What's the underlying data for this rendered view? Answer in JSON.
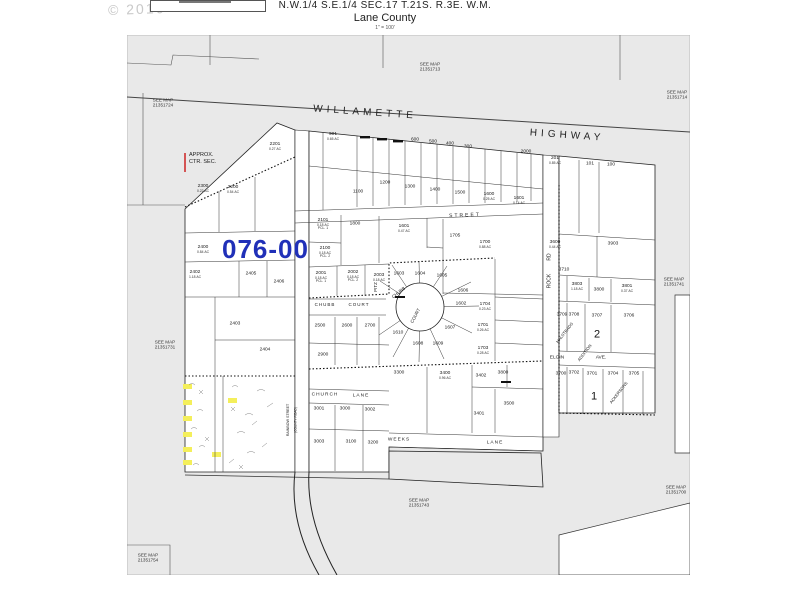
{
  "header": {
    "line1": "N.W.1/4 S.E.1/4 SEC.17 T.21S. R.3E. W.M.",
    "line2": "Lane County",
    "scale": "1\" = 100'",
    "copyright": "© 2016"
  },
  "map": {
    "district_code": "076-00",
    "approx_note_line1": "APPROX.",
    "approx_note_line2": "CTR. SEC.",
    "see_map_prefix": "SEE MAP",
    "colors": {
      "district": "#2030b8",
      "highlight": "#f4ef5b",
      "map_bg": "#e9e9e9",
      "tick": "#cc2222"
    },
    "see_maps": [
      {
        "ref": "21351713",
        "x": 303,
        "y": 32
      },
      {
        "ref": "21351724",
        "x": 36,
        "y": 68
      },
      {
        "ref": "21351714",
        "x": 550,
        "y": 60
      },
      {
        "ref": "21351741",
        "x": 547,
        "y": 247
      },
      {
        "ref": "21351731",
        "x": 38,
        "y": 310
      },
      {
        "ref": "21351743",
        "x": 292,
        "y": 468
      },
      {
        "ref": "21351700",
        "x": 549,
        "y": 455
      },
      {
        "ref": "21351754",
        "x": 21,
        "y": 523
      }
    ],
    "streets": [
      {
        "label": "WILLAMETTE",
        "x": 238,
        "y": 78,
        "rot": 4,
        "fs": 10,
        "ls": 4
      },
      {
        "label": "HIGHWAY",
        "x": 440,
        "y": 101,
        "rot": 4,
        "fs": 10,
        "ls": 4
      },
      {
        "label": "STREET",
        "x": 338,
        "y": 181,
        "rot": -2,
        "fs": 5,
        "ls": 2
      },
      {
        "label": "CHUBB",
        "x": 198,
        "y": 270,
        "fs": 4.5,
        "ls": 1
      },
      {
        "label": "COURT",
        "x": 232,
        "y": 270,
        "fs": 4.5,
        "ls": 1
      },
      {
        "label": "CHUBB",
        "x": 272,
        "y": 258,
        "rot": -38,
        "fs": 4.5
      },
      {
        "label": "COURT",
        "x": 289,
        "y": 281,
        "rot": -62,
        "fs": 4.5
      },
      {
        "label": "PITZ",
        "x": 249,
        "y": 252,
        "rot": -90,
        "fs": 4.5
      },
      {
        "label": "ROCK",
        "x": 423,
        "y": 246,
        "rot": -90,
        "fs": 5
      },
      {
        "label": "RD",
        "x": 423,
        "y": 222,
        "rot": -90,
        "fs": 5
      },
      {
        "label": "CHURCH",
        "x": 198,
        "y": 361,
        "fs": 4.8,
        "ls": 1
      },
      {
        "label": "LANE",
        "x": 234,
        "y": 362,
        "fs": 4.8,
        "ls": 1
      },
      {
        "label": "WEEKS",
        "x": 272,
        "y": 406,
        "fs": 4.8,
        "ls": 1
      },
      {
        "label": "LANE",
        "x": 368,
        "y": 409,
        "fs": 4.8,
        "ls": 1
      },
      {
        "label": "ELGIN",
        "x": 430,
        "y": 324,
        "fs": 4.8
      },
      {
        "label": "AVE.",
        "x": 474,
        "y": 324,
        "fs": 4.8
      },
      {
        "label": "RAINBOW STREET",
        "x": 162,
        "y": 385,
        "rot": -90,
        "fs": 3.6
      },
      {
        "label": "(COUNTY ROAD)",
        "x": 169,
        "y": 385,
        "rot": -90,
        "fs": 3.2
      },
      {
        "label": "HALSTEADS",
        "x": 438,
        "y": 298,
        "rot": -52,
        "fs": 4.2
      },
      {
        "label": "ADDITION",
        "x": 458,
        "y": 318,
        "rot": -52,
        "fs": 4.2
      },
      {
        "label": "ACKERSONS",
        "x": 492,
        "y": 358,
        "rot": -52,
        "fs": 4.2
      }
    ],
    "block_numbers": [
      {
        "label": "2",
        "x": 470,
        "y": 300
      },
      {
        "label": "1",
        "x": 467,
        "y": 362
      }
    ],
    "parcels": [
      {
        "n": "2201",
        "a": "0.27 AC",
        "x": 148,
        "y": 112
      },
      {
        "n": "2300",
        "a": "0.22 AC",
        "x": 76,
        "y": 154
      },
      {
        "n": "2200",
        "a": "0.54 AC",
        "x": 106,
        "y": 155
      },
      {
        "n": "2400",
        "a": "0.84 AC",
        "x": 76,
        "y": 215
      },
      {
        "n": "2402",
        "a": "1.18 AC",
        "x": 68,
        "y": 240
      },
      {
        "n": "2405",
        "a": "",
        "x": 124,
        "y": 240
      },
      {
        "n": "2406",
        "a": "",
        "x": 152,
        "y": 248
      },
      {
        "n": "2403",
        "a": "",
        "x": 108,
        "y": 290
      },
      {
        "n": "2404",
        "a": "",
        "x": 138,
        "y": 316
      },
      {
        "n": "901",
        "a": "0.65 AC",
        "x": 206,
        "y": 102
      },
      {
        "n": "600",
        "a": "",
        "x": 288,
        "y": 106
      },
      {
        "n": "500",
        "a": "",
        "x": 306,
        "y": 108
      },
      {
        "n": "400",
        "a": "",
        "x": 323,
        "y": 110
      },
      {
        "n": "300",
        "a": "",
        "x": 341,
        "y": 113
      },
      {
        "n": "2000",
        "a": "",
        "x": 399,
        "y": 118
      },
      {
        "n": "1100",
        "a": "",
        "x": 231,
        "y": 158
      },
      {
        "n": "1200",
        "a": "",
        "x": 258,
        "y": 149
      },
      {
        "n": "1300",
        "a": "",
        "x": 283,
        "y": 153
      },
      {
        "n": "1400",
        "a": "",
        "x": 308,
        "y": 156
      },
      {
        "n": "1500",
        "a": "",
        "x": 333,
        "y": 159
      },
      {
        "n": "1600",
        "a": "0.25 AC",
        "x": 362,
        "y": 162
      },
      {
        "n": "1601",
        "a": "0.14 AC",
        "x": 392,
        "y": 166
      },
      {
        "n": "2101",
        "a": "0.18 AC",
        "a2": "PCL. 1",
        "x": 196,
        "y": 190
      },
      {
        "n": "2100",
        "a": "0.18 AC",
        "a2": "PCL. 2",
        "x": 198,
        "y": 218
      },
      {
        "n": "1800",
        "a": "",
        "x": 228,
        "y": 190
      },
      {
        "n": "1601",
        "a": "0.47 AC",
        "x": 277,
        "y": 194
      },
      {
        "n": "1705",
        "a": "",
        "x": 328,
        "y": 202
      },
      {
        "n": "1700",
        "a": "0.88 AC",
        "x": 358,
        "y": 210
      },
      {
        "n": "2001",
        "a": "0.18 AC",
        "a2": "PCL. 1",
        "x": 194,
        "y": 243
      },
      {
        "n": "2002",
        "a": "0.18 AC",
        "a2": "PCL. 2",
        "x": 226,
        "y": 242
      },
      {
        "n": "2003",
        "a": "0.18 AC",
        "x": 252,
        "y": 243
      },
      {
        "n": "1603",
        "a": "",
        "x": 272,
        "y": 240
      },
      {
        "n": "1604",
        "a": "",
        "x": 293,
        "y": 240
      },
      {
        "n": "1605",
        "a": "",
        "x": 315,
        "y": 242
      },
      {
        "n": "1606",
        "a": "",
        "x": 336,
        "y": 257
      },
      {
        "n": "1602",
        "a": "",
        "x": 334,
        "y": 270
      },
      {
        "n": "1704",
        "a": "0.23 AC",
        "x": 358,
        "y": 272
      },
      {
        "n": "1701",
        "a": "0.26 AC",
        "x": 356,
        "y": 293
      },
      {
        "n": "1607",
        "a": "",
        "x": 323,
        "y": 294
      },
      {
        "n": "1610",
        "a": "",
        "x": 271,
        "y": 299
      },
      {
        "n": "1608",
        "a": "",
        "x": 291,
        "y": 310
      },
      {
        "n": "1609",
        "a": "",
        "x": 311,
        "y": 310
      },
      {
        "n": "1703",
        "a": "0.28 AC",
        "x": 356,
        "y": 316
      },
      {
        "n": "2500",
        "a": "",
        "x": 193,
        "y": 292
      },
      {
        "n": "2600",
        "a": "",
        "x": 220,
        "y": 292
      },
      {
        "n": "2700",
        "a": "",
        "x": 243,
        "y": 292
      },
      {
        "n": "2900",
        "a": "",
        "x": 196,
        "y": 321
      },
      {
        "n": "3300",
        "a": "",
        "x": 272,
        "y": 339
      },
      {
        "n": "3400",
        "a": "0.96 AC",
        "x": 318,
        "y": 341
      },
      {
        "n": "3402",
        "a": "",
        "x": 354,
        "y": 342
      },
      {
        "n": "3800",
        "a": "",
        "x": 376,
        "y": 339
      },
      {
        "n": "3401",
        "a": "",
        "x": 352,
        "y": 380
      },
      {
        "n": "3500",
        "a": "",
        "x": 382,
        "y": 370
      },
      {
        "n": "3001",
        "a": "",
        "x": 192,
        "y": 375
      },
      {
        "n": "3000",
        "a": "",
        "x": 218,
        "y": 375
      },
      {
        "n": "3002",
        "a": "",
        "x": 243,
        "y": 376
      },
      {
        "n": "3003",
        "a": "",
        "x": 192,
        "y": 408
      },
      {
        "n": "3100",
        "a": "",
        "x": 224,
        "y": 408
      },
      {
        "n": "3200",
        "a": "",
        "x": 246,
        "y": 409
      },
      {
        "n": "201",
        "a": "0.85 AC",
        "x": 428,
        "y": 126
      },
      {
        "n": "101",
        "a": "",
        "x": 463,
        "y": 130
      },
      {
        "n": "100",
        "a": "",
        "x": 484,
        "y": 131
      },
      {
        "n": "3600",
        "a": "0.44 AC",
        "x": 428,
        "y": 210
      },
      {
        "n": "3903",
        "a": "",
        "x": 486,
        "y": 210
      },
      {
        "n": "3710",
        "a": "",
        "x": 437,
        "y": 236
      },
      {
        "n": "3803",
        "a": "1.18 AC",
        "x": 450,
        "y": 252
      },
      {
        "n": "3800",
        "a": "",
        "x": 472,
        "y": 256
      },
      {
        "n": "3801",
        "a": "0.37 AC",
        "x": 500,
        "y": 254
      },
      {
        "n": "3709",
        "a": "",
        "x": 435,
        "y": 281
      },
      {
        "n": "3708",
        "a": "",
        "x": 447,
        "y": 281
      },
      {
        "n": "3707",
        "a": "",
        "x": 470,
        "y": 282
      },
      {
        "n": "3706",
        "a": "",
        "x": 502,
        "y": 282
      },
      {
        "n": "3700",
        "a": "",
        "x": 434,
        "y": 340
      },
      {
        "n": "3702",
        "a": "",
        "x": 447,
        "y": 339
      },
      {
        "n": "3701",
        "a": "",
        "x": 465,
        "y": 340
      },
      {
        "n": "3704",
        "a": "",
        "x": 486,
        "y": 340
      },
      {
        "n": "3705",
        "a": "",
        "x": 507,
        "y": 340
      }
    ],
    "highlights": [
      {
        "x": 60,
        "y": 352
      },
      {
        "x": 60,
        "y": 368
      },
      {
        "x": 60,
        "y": 384
      },
      {
        "x": 60,
        "y": 400
      },
      {
        "x": 60,
        "y": 415
      },
      {
        "x": 60,
        "y": 428
      },
      {
        "x": 106,
        "y": 366
      },
      {
        "x": 90,
        "y": 420
      }
    ]
  }
}
